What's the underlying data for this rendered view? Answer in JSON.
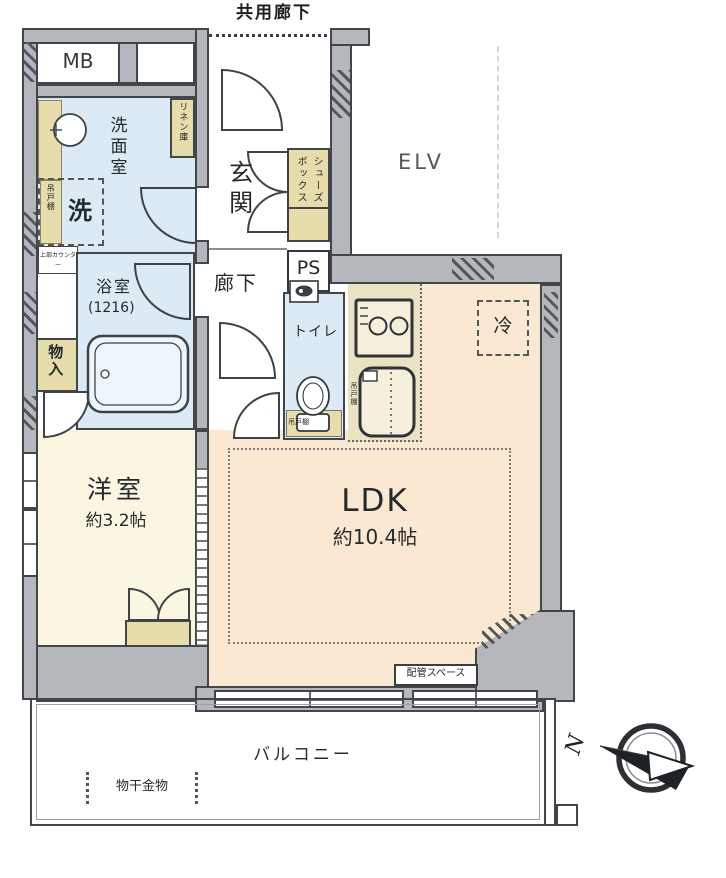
{
  "labels": {
    "common_corridor": "共用廊下",
    "mb": "MB",
    "washroom": "洗面室",
    "linen_closet": "リネン庫",
    "hanging_cupboard": "吊戸棚",
    "washer": "洗",
    "upper_counter": "上部カウンター",
    "entrance": "玄関",
    "shoe_box": "シューズボックス",
    "ps": "PS",
    "hallway": "廊下",
    "toilet": "トイレ",
    "bathroom": "浴室",
    "bathroom_size": "(1216)",
    "storage": "物入",
    "elevator": "ELV",
    "fridge": "冷",
    "kitchen_cupboard": "吊戸棚",
    "toilet_cupboard": "吊戸棚",
    "ldk": "LDK",
    "ldk_size": "約10.4帖",
    "western_room": "洋室",
    "western_room_size": "約3.2帖",
    "piping_space": "配管スペース",
    "balcony": "バルコニー",
    "laundry_hardware": "物干金物",
    "north": "N"
  },
  "colors": {
    "wall": "#b4b8bc",
    "outline": "#42464b",
    "wet_area_floor": "#dceaf6",
    "ldk_floor": "#fbe8d2",
    "western_room_floor": "#faf6e2",
    "cabinet": "#e7dcab",
    "kitchen_counter": "#eae3c3"
  }
}
